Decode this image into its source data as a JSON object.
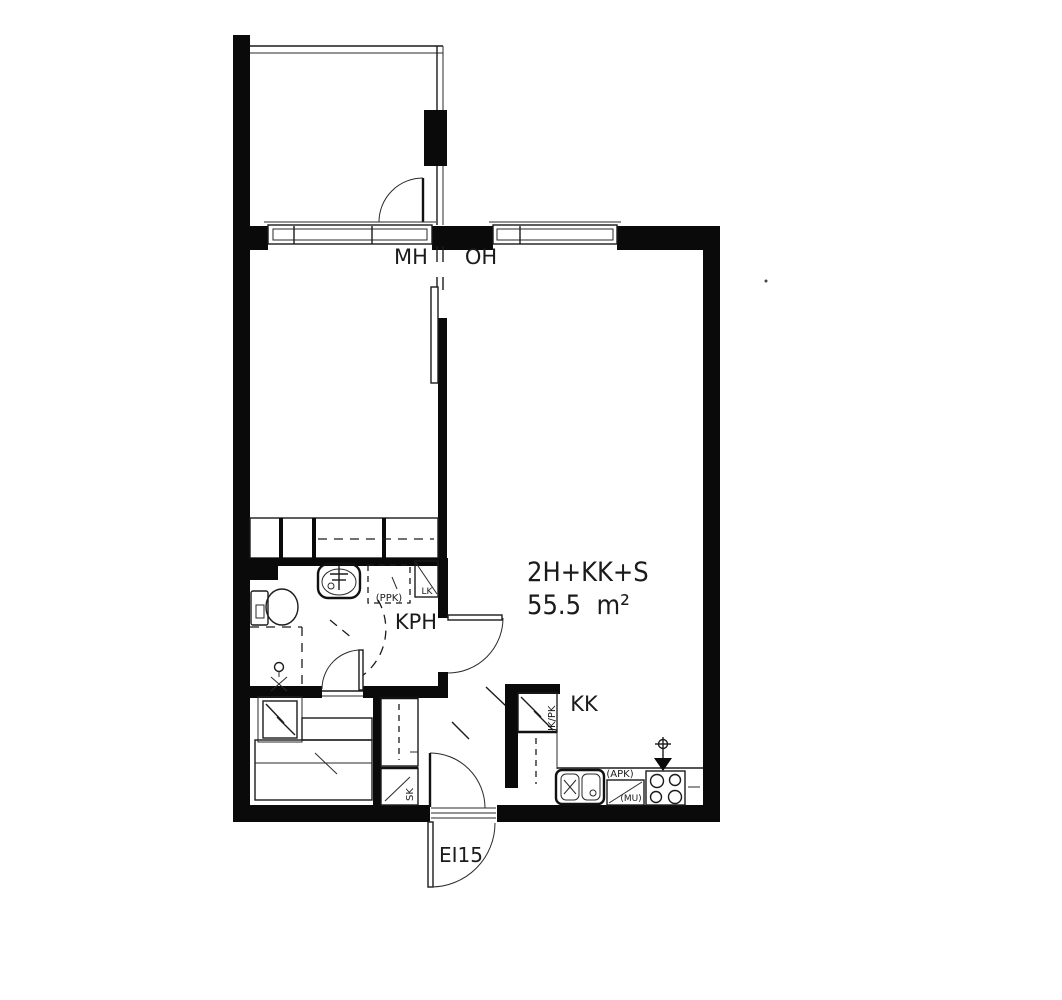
{
  "page": {
    "background": "#ffffff",
    "line_color": "#1b1b1b",
    "wall_color": "#0a0a0a"
  },
  "plan": {
    "apartment_type": "2H+KK+S",
    "apartment_area": "55.5  m²",
    "labels": {
      "bedroom": "MH",
      "living_room": "OH",
      "bathroom": "KPH",
      "kitchenette": "KK",
      "entrance_door_rating": "EI15",
      "washing_machine_reservation": "(PPK)",
      "linen_closet": "LK",
      "cleaning_closet": "SK",
      "fridge_freezer": "JK/PK",
      "dishwasher_reservation": "(APK)",
      "microwave_reservation": "(MU)"
    }
  }
}
